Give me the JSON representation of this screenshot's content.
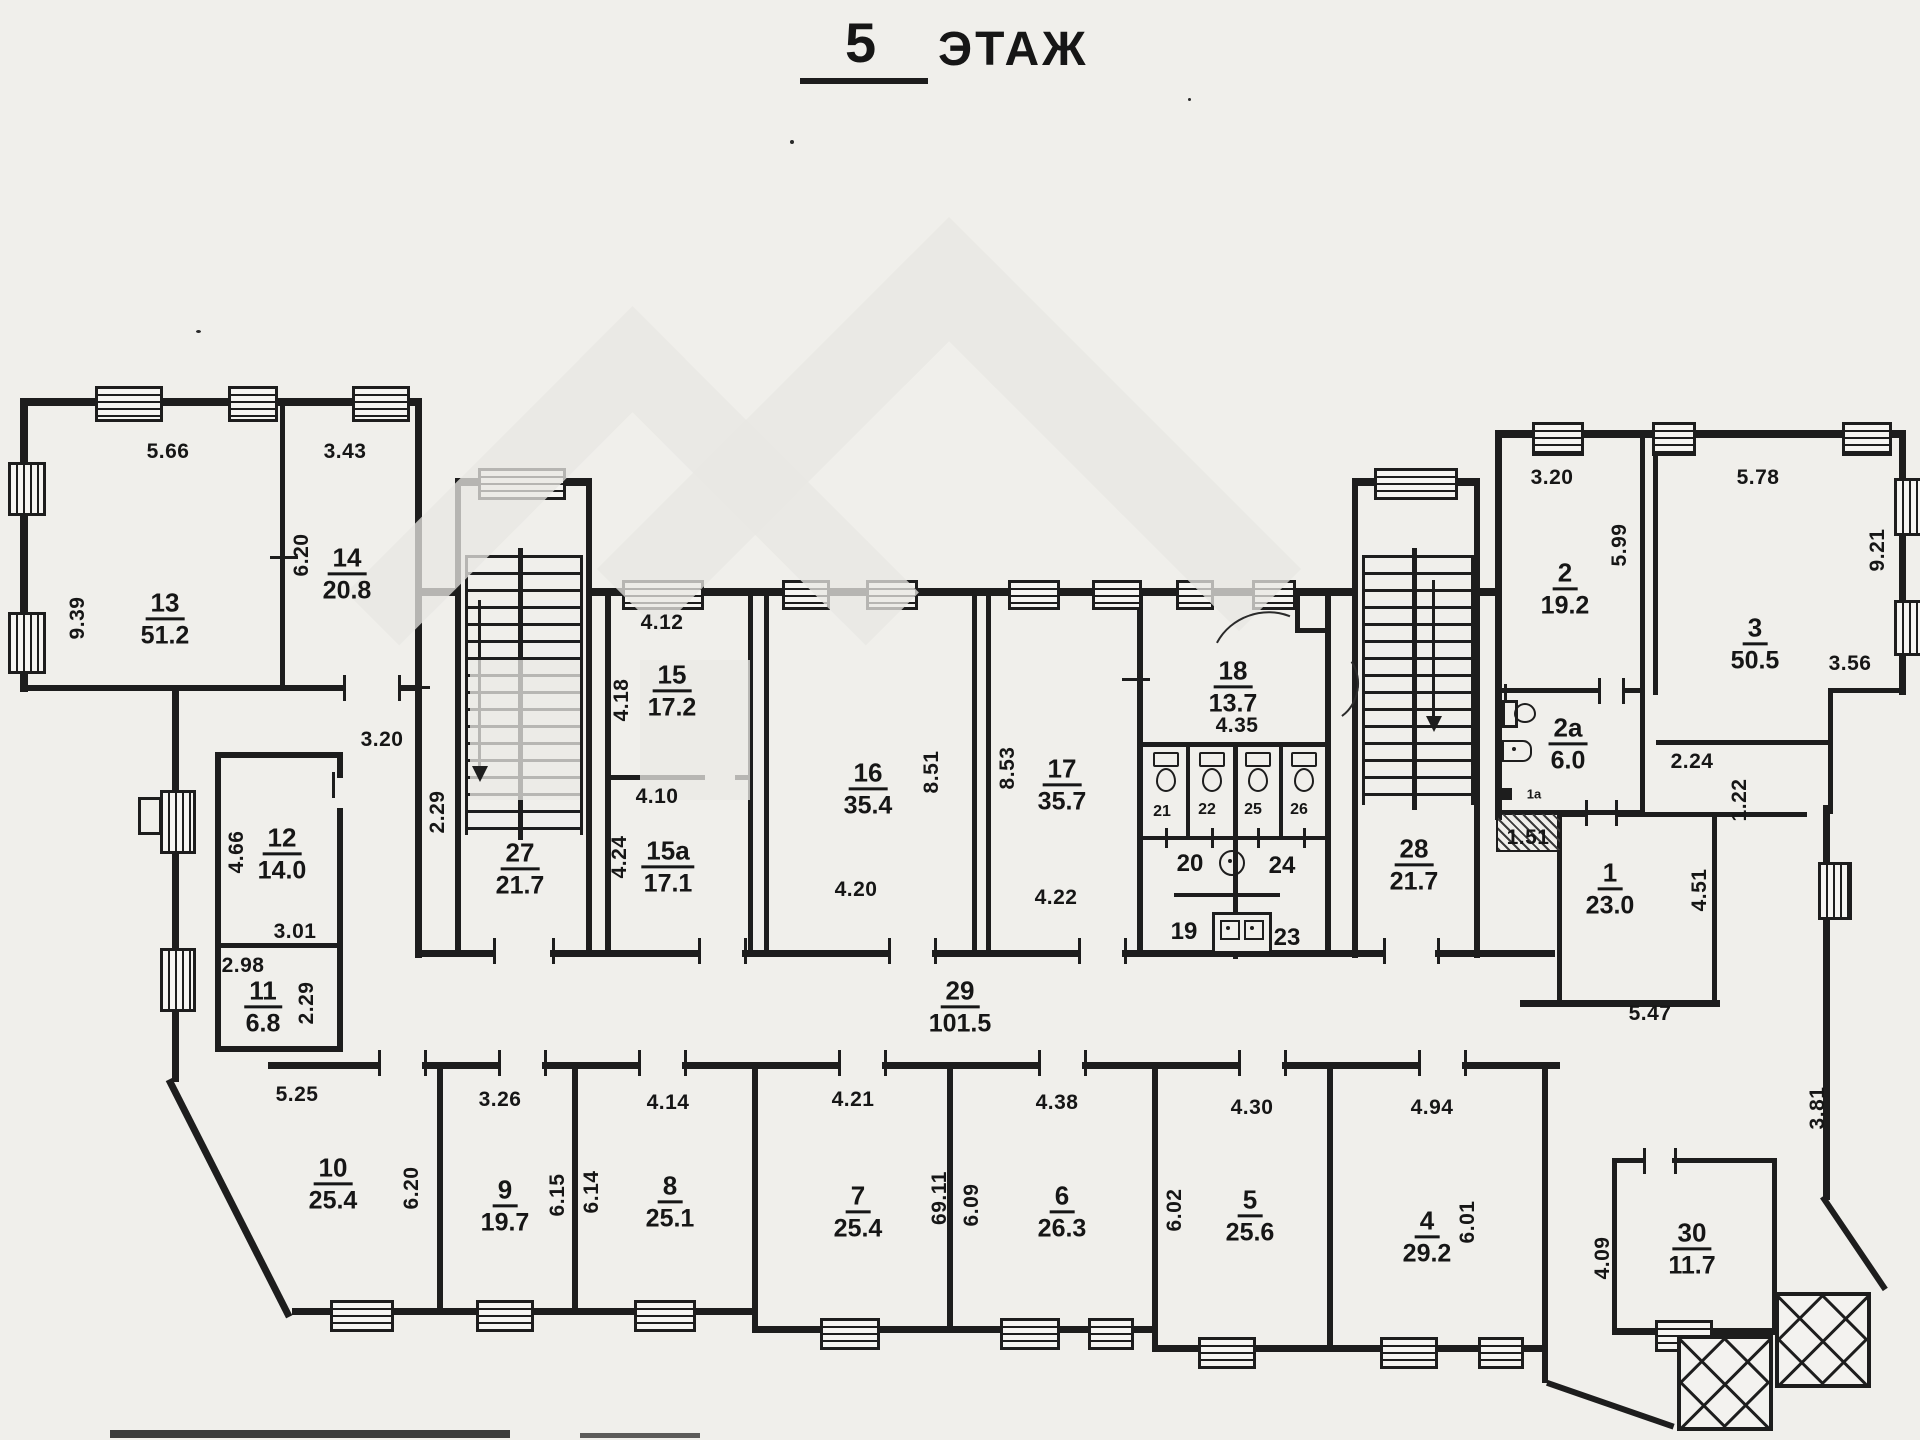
{
  "title": {
    "number": "5",
    "word": "ЭТАЖ"
  },
  "rooms": {
    "r1": {
      "num": "1",
      "area": "23.0"
    },
    "r2": {
      "num": "2",
      "area": "19.2"
    },
    "r2a": {
      "num": "2а",
      "area": "6.0"
    },
    "r3": {
      "num": "3",
      "area": "50.5"
    },
    "r4": {
      "num": "4",
      "area": "29.2"
    },
    "r5": {
      "num": "5",
      "area": "25.6"
    },
    "r6": {
      "num": "6",
      "area": "26.3"
    },
    "r7": {
      "num": "7",
      "area": "25.4"
    },
    "r8": {
      "num": "8",
      "area": "25.1"
    },
    "r9": {
      "num": "9",
      "area": "19.7"
    },
    "r10": {
      "num": "10",
      "area": "25.4"
    },
    "r11": {
      "num": "11",
      "area": "6.8"
    },
    "r12": {
      "num": "12",
      "area": "14.0"
    },
    "r13": {
      "num": "13",
      "area": "51.2"
    },
    "r14": {
      "num": "14",
      "area": "20.8"
    },
    "r15": {
      "num": "15",
      "area": "17.2"
    },
    "r15a": {
      "num": "15а",
      "area": "17.1"
    },
    "r16": {
      "num": "16",
      "area": "35.4"
    },
    "r17": {
      "num": "17",
      "area": "35.7"
    },
    "r18": {
      "num": "18",
      "area": "13.7"
    },
    "r27": {
      "num": "27",
      "area": "21.7"
    },
    "r28": {
      "num": "28",
      "area": "21.7"
    },
    "r29": {
      "num": "29",
      "area": "101.5"
    },
    "r30": {
      "num": "30",
      "area": "11.7"
    }
  },
  "cells": {
    "c19": "19",
    "c20": "20",
    "c21": "21",
    "c22": "22",
    "c23": "23",
    "c24": "24",
    "c25": "25",
    "c26": "26",
    "c1a": "1а"
  },
  "dims": {
    "d5_66": "5.66",
    "d3_43": "3.43",
    "d9_39": "9.39",
    "d6_20a": "6.20",
    "d3_20a": "3.20",
    "d4_66": "4.66",
    "d3_01": "3.01",
    "d2_98": "2.98",
    "d2_29a": "2.29",
    "d2_29b": "2.29",
    "d4_12": "4.12",
    "d4_18": "4.18",
    "d4_10": "4.10",
    "d4_24": "4.24",
    "d8_51": "8.51",
    "d4_20": "4.20",
    "d8_53": "8.53",
    "d4_22": "4.22",
    "d4_35": "4.35",
    "d3_20b": "3.20",
    "d5_99": "5.99",
    "d5_78": "5.78",
    "d9_21": "9.21",
    "d2_24": "2.24",
    "d1_22": "1.22",
    "d3_56": "3.56",
    "d1_51": "1.51",
    "d4_51": "4.51",
    "d5_47": "5.47",
    "d3_81": "3.81",
    "d5_25": "5.25",
    "d3_26": "3.26",
    "d4_14": "4.14",
    "d4_21": "4.21",
    "d4_38": "4.38",
    "d4_30": "4.30",
    "d4_94": "4.94",
    "d6_20b": "6.20",
    "d6_15": "6.15",
    "d6_14": "6.14",
    "d69_11": "69.11",
    "d6_09": "6.09",
    "d6_02": "6.02",
    "d6_01": "6.01",
    "d4_09": "4.09"
  }
}
